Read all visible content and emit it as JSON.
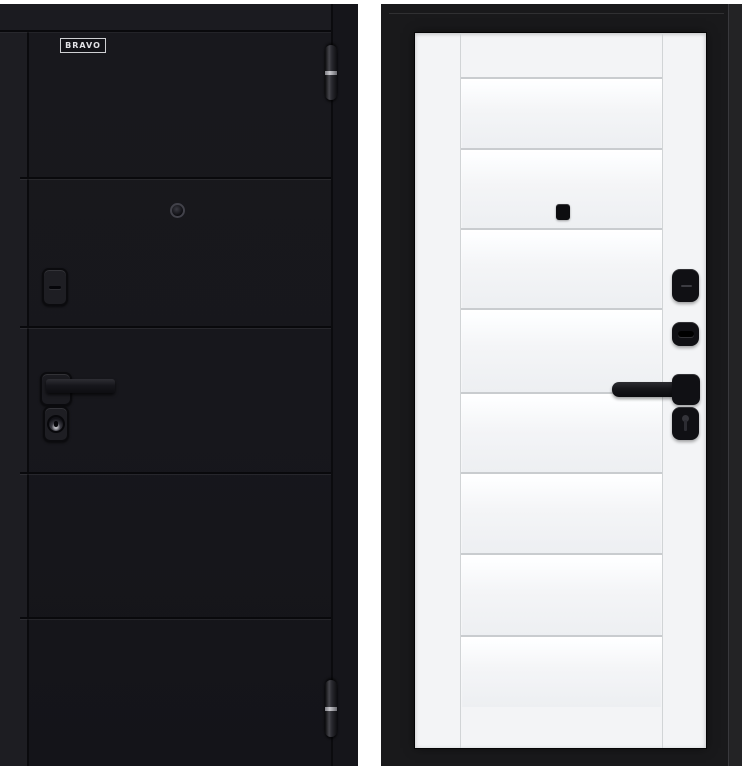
{
  "product": {
    "brand_badge": "BRAVO"
  },
  "colors": {
    "background": "#ffffff",
    "door_black": "#17171c",
    "door_black_edge": "#1d1d22",
    "groove": "#09090c",
    "frame_black": "#19191b",
    "frame_edge_strip": "#232325",
    "leaf_white": "#f3f4f6",
    "panel_line": "#c9cccf",
    "panel_glass_bottom": "#edeff2",
    "hardware_black": "#101014",
    "hinge_metal": "#c6c6cb",
    "badge_border": "#cfd0d3"
  }
}
